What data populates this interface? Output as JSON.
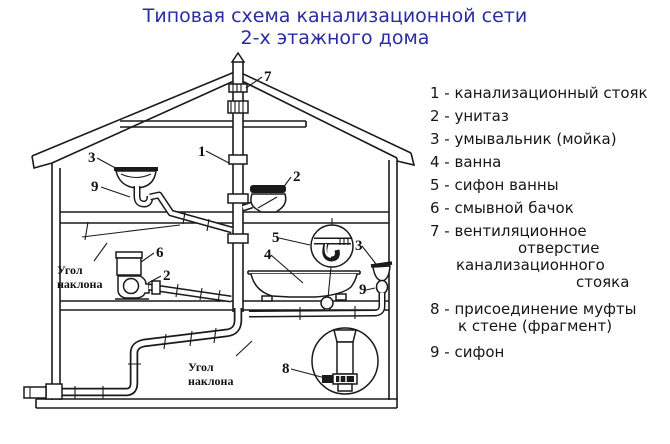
{
  "title": {
    "line1": "Типовая схема канализационной сети",
    "line2": "2-х этажного дома"
  },
  "colors": {
    "title_text": "#2b2ba3",
    "drawing_ink": "#1a1a1a",
    "background": "#ffffff"
  },
  "legend": {
    "lines": [
      "1 - канализационный стояк",
      "2 - унитаз",
      "3 - умывальник (мойка)",
      "4 - ванна",
      "5 - сифон ванны",
      "6 - смывной бачок",
      "7 - вентиляционное",
      "отверстие",
      "канализационного",
      "стояка",
      "8 - присоединение муфты",
      "к стене (фрагмент)",
      "9 - сифон"
    ]
  },
  "diagram": {
    "numbers": {
      "n1": "1",
      "n2": "2",
      "n3": "3",
      "n4": "4",
      "n5": "5",
      "n6": "6",
      "n7": "7",
      "n8": "8",
      "n9": "9"
    },
    "slope": {
      "line1": "Угол",
      "line2": "наклона"
    }
  }
}
